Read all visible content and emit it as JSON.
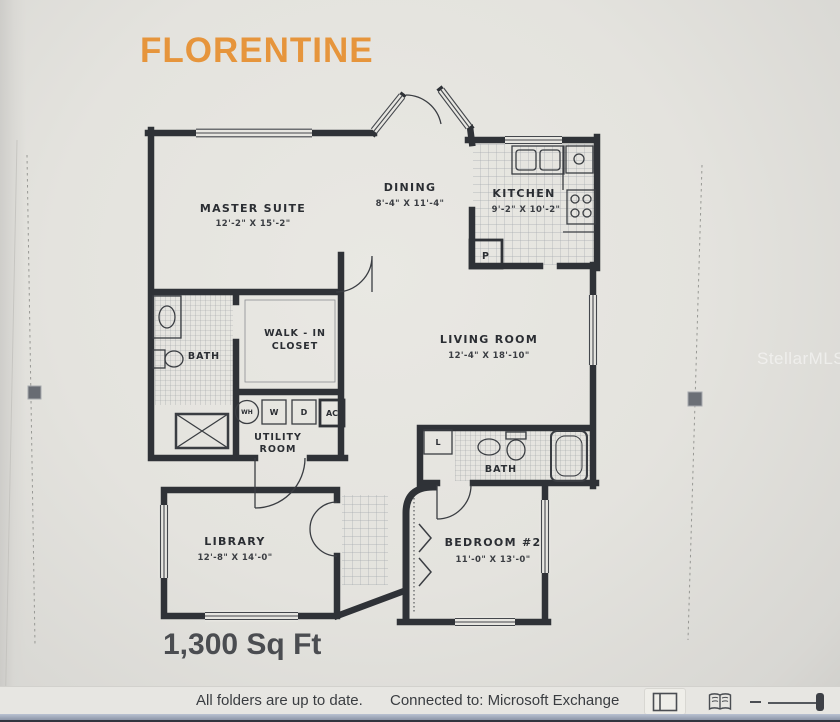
{
  "title": "FLORENTINE",
  "area_label": "1,300 Sq Ft",
  "watermark": "StellarMLS",
  "colors": {
    "title_orange": "#e6953c",
    "wall_dark": "#2f3237",
    "status_text": "#3a3d41"
  },
  "plan": {
    "master_suite": {
      "name": "MASTER SUITE",
      "dims": "12'-2\" X 15'-2\""
    },
    "dining": {
      "name": "DINING",
      "dims": "8'-4\" X 11'-4\""
    },
    "kitchen": {
      "name": "KITCHEN",
      "dims": "9'-2\" X 10'-2\""
    },
    "walk_in_closet": {
      "line1": "WALK - IN",
      "line2": "CLOSET"
    },
    "master_bath": {
      "name": "BATH"
    },
    "living_room": {
      "name": "LIVING ROOM",
      "dims": "12'-4\" X 18'-10\""
    },
    "utility_room": {
      "line1": "UTILITY",
      "line2": "ROOM"
    },
    "library": {
      "name": "LIBRARY",
      "dims": "12'-8\" X 14'-0\""
    },
    "bath2": {
      "name": "BATH"
    },
    "bedroom2": {
      "name": "BEDROOM #2",
      "dims": "11'-0\" X 13'-0\""
    },
    "appliances": {
      "wh": "WH",
      "w": "W",
      "d": "D",
      "ac": "AC",
      "p": "P",
      "l": "L"
    }
  },
  "statusbar": {
    "folders": "All folders are up to date.",
    "connection": "Connected to: Microsoft Exchange"
  }
}
